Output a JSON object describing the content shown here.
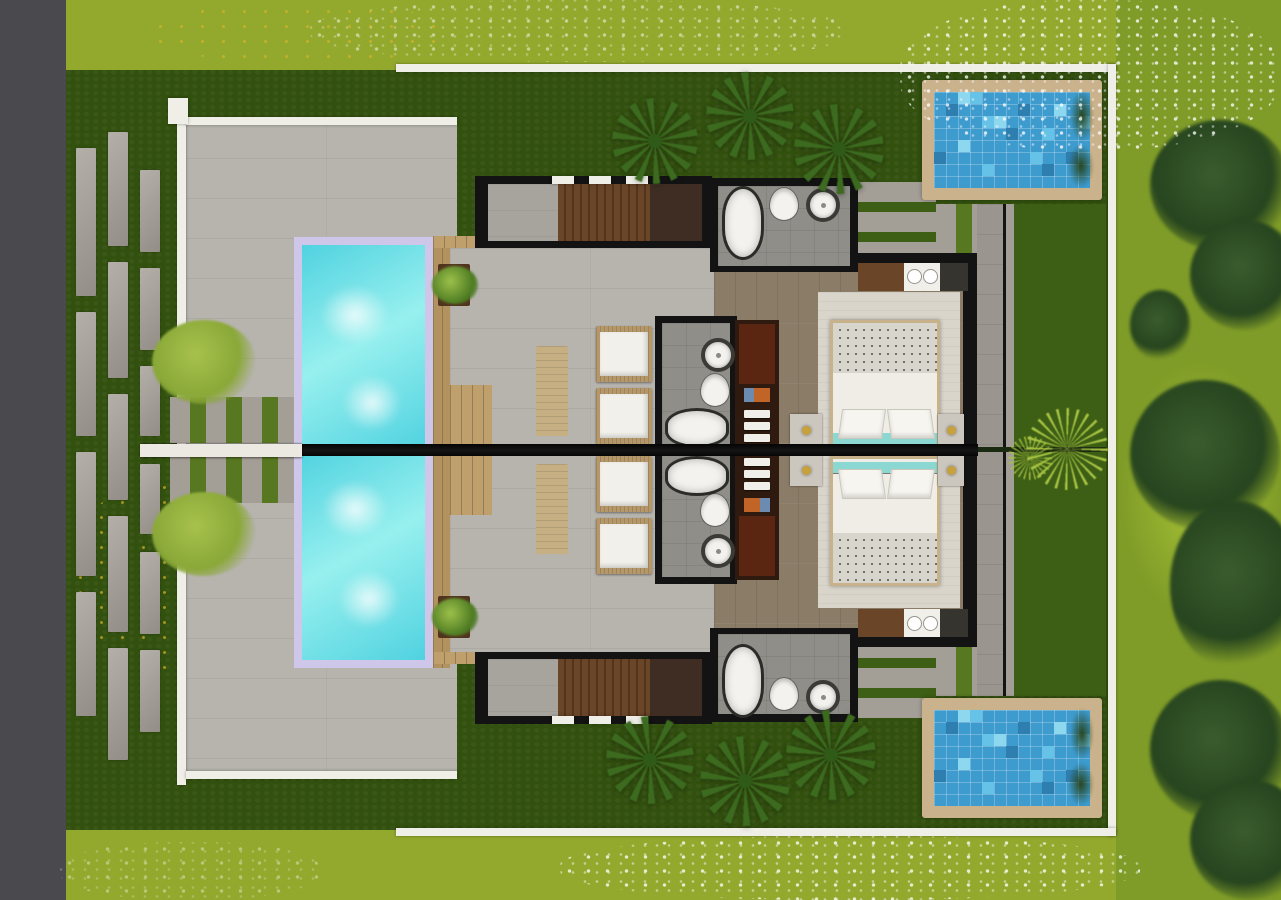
{
  "scene": {
    "description": "Top-down architectural 3D rendering of two mirrored luxury pool villas with shared central core, lap pools, plunge pools and tropical landscaping",
    "villas": 2,
    "inventory": {
      "main_lap_pools": 2,
      "mosaic_plunge_pools": 2,
      "bedrooms_with_double_bed": 2,
      "main_bathrooms": 2,
      "ensuite_bathrooms": 2,
      "freestanding_bathtubs": 4,
      "toilets": 4,
      "round_basins": 4,
      "lounge_chairs": 4,
      "sun_mats": 2,
      "wood_decks": 2,
      "fan_palm_trees": 6,
      "garden_shrubs": 2,
      "ornamental_spike_plants": 2,
      "stepping_stone_paths": 3
    }
  },
  "palette": {
    "sidebar": "#4a4a4e",
    "outerGrass": "#93a92d",
    "outerGrassRight": "#7f9c28",
    "outerBright": "#aac437",
    "innerLawn": "#32500e",
    "midGrass": "#577721",
    "gardenGrass": "#3d5e15",
    "wallWhite": "#efeee7",
    "terrace": "#b7b4ae",
    "slab": "#a39e96",
    "pathGray": "#9a968f",
    "walkwayWhite": "#ebe9e2",
    "poolRim": "#cfc7e9",
    "water1": "#50d2e0",
    "water2": "#97f0ee",
    "deckWood": "#b2925f",
    "deckWoodLight": "#bf9f6c",
    "frameTan": "#c9b28c",
    "mosaic1": "#3d9bce",
    "mosaic2": "#66c2e6",
    "mosaic3": "#2e7fb0",
    "mosaic4": "#8ed8ef",
    "frameBlack": "#131313",
    "concrete": "#a7a49e",
    "slatWood": "#6b4527",
    "slatWoodDark": "#51341e",
    "woodDark": "#3f2d23",
    "bathFloor": "#8f8e88",
    "fixtureWhite": "#f3f2ee",
    "fixtureRim": "#2b2b28",
    "floorWood": "#8b7c68",
    "rug": "#d9d5cb",
    "latticeBase": "#d8d5cc",
    "latticeLine": "#70706a",
    "duvet": "#efede6",
    "teal": "#8bd7d1",
    "bedFrame": "#c7b28b",
    "nightstand": "#cbc7be",
    "gold": "#c9a13c",
    "wardrobe": "#2e1a0f",
    "wardrobeRed": "#5a2511",
    "orange": "#c06428",
    "boxBlue": "#6b8cb0",
    "rattan": "#b5976a",
    "cushion": "#f2f0ea",
    "mat": "#c6b083",
    "palm": "#3c6b1f",
    "palmDark": "#2f5a18",
    "bush": "#8aa838",
    "tree": "#27451f",
    "spiky": "#a6c342",
    "leafYellow": "#d7b32c"
  }
}
